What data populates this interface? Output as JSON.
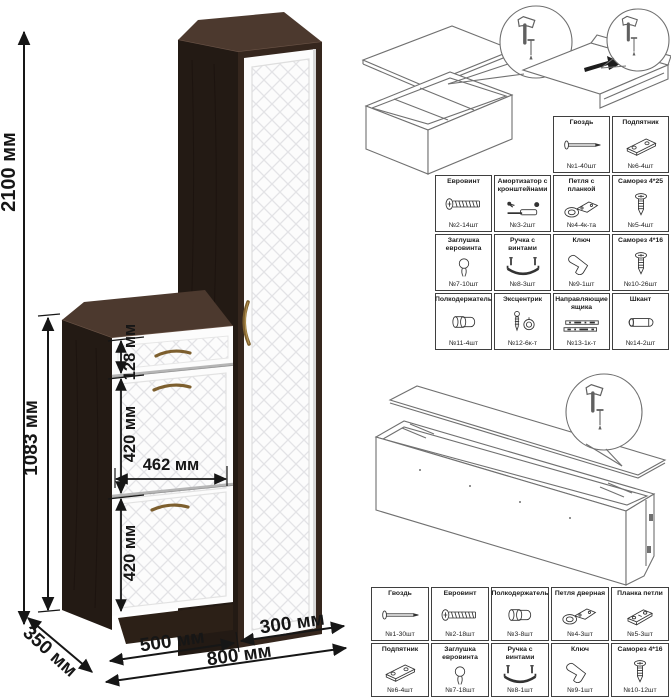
{
  "dimensions": {
    "total_height": "2100 мм",
    "section_height": "1083 мм",
    "drawer_height": "128 мм",
    "flap_upper_height": "420 мм",
    "flap_inner_width": "462 мм",
    "flap_lower_height": "420 мм",
    "shoe_cabinet_width": "500 мм",
    "wardrobe_width": "300 мм",
    "total_width": "800 мм",
    "depth": "350 мм"
  },
  "parts_table_main": {
    "rows": [
      {
        "offset": 2,
        "cells": [
          {
            "name": "Гвоздь",
            "qty": "№1-40шт",
            "icon": "nail-icon"
          },
          {
            "name": "Подпятник",
            "qty": "№6-4шт",
            "icon": "footplate-icon"
          }
        ]
      },
      {
        "cells": [
          {
            "name": "Евровинт",
            "qty": "№2-14шт",
            "icon": "euroscrew-icon"
          },
          {
            "name": "Амортизатор с кронштейнами",
            "qty": "№3-2шт",
            "icon": "gas-strut-icon"
          },
          {
            "name": "Петля с планкой",
            "qty": "№4-4к-та",
            "icon": "hinge-icon"
          },
          {
            "name": "Саморез 4*25",
            "qty": "№5-4шт",
            "icon": "screw-icon"
          }
        ]
      },
      {
        "cells": [
          {
            "name": "Заглушка евровинта",
            "qty": "№7-10шт",
            "icon": "cap-icon"
          },
          {
            "name": "Ручка с винтами",
            "qty": "№8-3шт",
            "icon": "handle-icon"
          },
          {
            "name": "Ключ",
            "qty": "№9-1шт",
            "icon": "key-icon"
          },
          {
            "name": "Саморез 4*16",
            "qty": "№10-26шт",
            "icon": "screw-icon"
          }
        ]
      },
      {
        "cells": [
          {
            "name": "Полкодержатель",
            "qty": "№11-4шт",
            "icon": "shelf-pin-icon"
          },
          {
            "name": "Эксцентрик",
            "qty": "№12-6к-т",
            "icon": "cam-icon"
          },
          {
            "name": "Направляющие ящика",
            "qty": "№13-1к-т",
            "icon": "drawer-slides-icon"
          },
          {
            "name": "Шкант",
            "qty": "№14-2шт",
            "icon": "dowel-icon"
          }
        ]
      }
    ]
  },
  "parts_table_bottom": {
    "rows": [
      {
        "cells": [
          {
            "name": "Гвоздь",
            "qty": "№1-30шт",
            "icon": "nail-icon"
          },
          {
            "name": "Евровинт",
            "qty": "№2-18шт",
            "icon": "euroscrew-icon"
          },
          {
            "name": "Полкодержатель",
            "qty": "№3-8шт",
            "icon": "shelf-pin-icon"
          },
          {
            "name": "Петля дверная",
            "qty": "№4-3шт",
            "icon": "hinge-icon"
          },
          {
            "name": "Планка петли",
            "qty": "№5-3шт",
            "icon": "hinge-plate-icon"
          }
        ]
      },
      {
        "cells": [
          {
            "name": "Подпятник",
            "qty": "№6-4шт",
            "icon": "footplate-icon"
          },
          {
            "name": "Заглушка евровинта",
            "qty": "№7-18шт",
            "icon": "cap-icon"
          },
          {
            "name": "Ручка с винтами",
            "qty": "№8-1шт",
            "icon": "handle-icon"
          },
          {
            "name": "Ключ",
            "qty": "№9-1шт",
            "icon": "key-icon"
          },
          {
            "name": "Саморез 4*16",
            "qty": "№10-12шт",
            "icon": "screw-icon"
          }
        ]
      }
    ]
  },
  "colors": {
    "wenge_front": "#35261d",
    "wenge_side": "#231a14",
    "wenge_top": "#4c392e",
    "facade_white": "#fcfcfc",
    "handle_brass": "#7d5f2e",
    "dimension_text": "#161616",
    "table_border": "#3f3f3f",
    "line_art": "#6f6f6f"
  }
}
